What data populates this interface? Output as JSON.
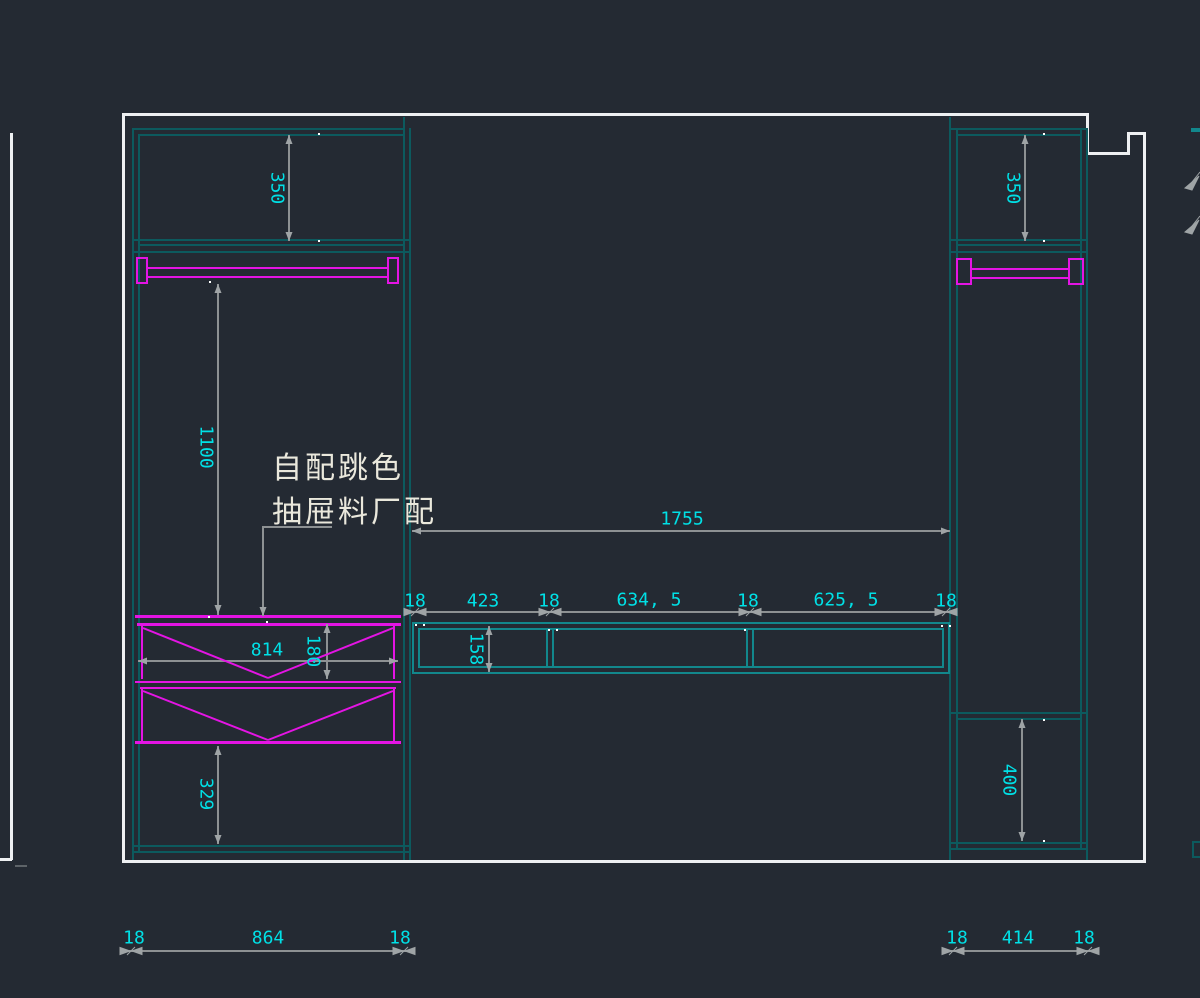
{
  "annotation": {
    "line1": "自配跳色",
    "line2": "抽屉料厂配"
  },
  "dimensions": {
    "left_cabinet": {
      "top_shelf": "350",
      "hang_space": "1100",
      "drawer_width": "814",
      "drawer_height": "180",
      "base_space": "329",
      "outer_width": [
        "18",
        "864",
        "18"
      ]
    },
    "bench": {
      "total_width": "1755",
      "height": "158",
      "segments": [
        "18",
        "423",
        "18",
        "634, 5",
        "18",
        "625, 5",
        "18"
      ]
    },
    "right_cabinet": {
      "top_shelf": "350",
      "lower_shelf": "400",
      "outer_width": [
        "18",
        "414",
        "18"
      ]
    }
  },
  "colors": {
    "background": "#242a33",
    "outline": "#eef0f2",
    "cabinet_line": "#0c5a5e",
    "bench_line": "#12878c",
    "drawer_accent": "#e414e4",
    "dimension_text": "#00e0e6",
    "dimension_line": "#8d9193",
    "annotation_text": "#eae8dc"
  }
}
